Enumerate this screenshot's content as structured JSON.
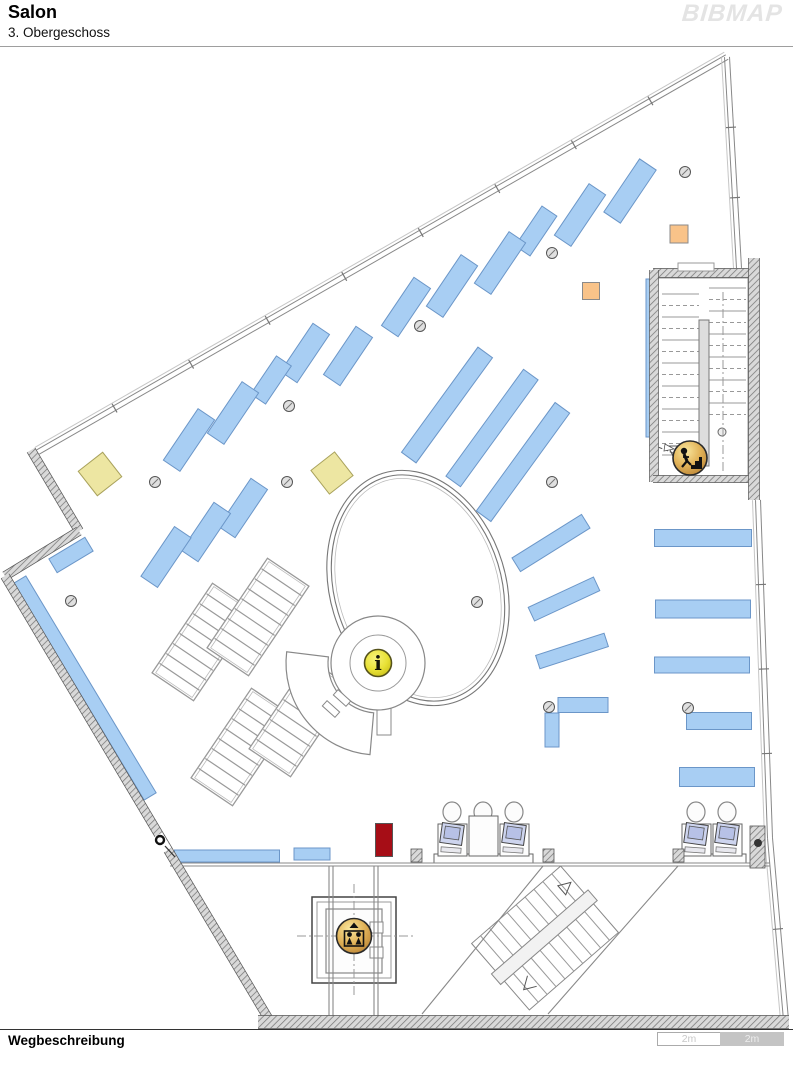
{
  "header": {
    "title": "Salon",
    "subtitle": "3. Obergeschoss",
    "logo": "BIBMAP"
  },
  "footer": {
    "label": "Wegbeschreibung",
    "scale": {
      "segments": [
        {
          "label": "2m"
        },
        {
          "label": "2m"
        }
      ]
    }
  },
  "colors": {
    "shelf_fill": "#A8CEF3",
    "shelf_stroke": "#6B96C8",
    "yellow_fill": "#EDE6A2",
    "yellow_stroke": "#A9A25C",
    "orange_fill": "#F9C389",
    "orange_stroke": "#8A8A8A",
    "red_fill": "#A60D16",
    "red_stroke": "#555555",
    "wall_line": "#555555",
    "icon_ring": "#2A2A2A",
    "info_yellow": "#E8E13C",
    "icon_gold": "#D9A93C"
  },
  "map": {
    "outline_walls": [
      [
        31,
        450,
        79,
        531,
        9
      ],
      [
        79,
        531,
        5,
        576,
        9
      ],
      [
        5,
        576,
        268,
        1018,
        9
      ],
      [
        258,
        1022,
        789,
        1022,
        13
      ],
      [
        653,
        273,
        757,
        273,
        9
      ],
      [
        654,
        270,
        654,
        482,
        9
      ],
      [
        653,
        479,
        757,
        479,
        7
      ],
      [
        754,
        258,
        754,
        500,
        11
      ]
    ],
    "glass_walls": [
      {
        "x1": 727,
        "y1": 57,
        "x2": 38,
        "y2": 452,
        "ticks": 9
      },
      {
        "x1": 727,
        "y1": 57,
        "x2": 739,
        "y2": 268,
        "ticks": 3
      },
      {
        "x1": 758,
        "y1": 500,
        "x2": 770,
        "y2": 838,
        "ticks": 4
      },
      {
        "x1": 770,
        "y1": 838,
        "x2": 786,
        "y2": 1020,
        "ticks": 2
      }
    ],
    "thin_walls": [
      [
        170,
        863,
        770,
        863
      ],
      [
        170,
        866,
        770,
        866
      ],
      [
        329,
        866,
        329,
        1016
      ],
      [
        333,
        866,
        333,
        1016
      ],
      [
        374,
        866,
        374,
        1016
      ],
      [
        378,
        866,
        378,
        1016
      ],
      [
        543,
        866,
        422,
        1014
      ],
      [
        678,
        866,
        548,
        1014
      ]
    ],
    "shelves": [
      [
        630,
        191,
        20,
        64,
        34
      ],
      [
        580,
        215,
        20,
        62,
        34
      ],
      [
        536,
        231,
        18,
        48,
        34
      ],
      [
        500,
        263,
        20,
        62,
        34
      ],
      [
        452,
        286,
        20,
        62,
        34
      ],
      [
        406,
        307,
        20,
        58,
        34
      ],
      [
        348,
        356,
        20,
        58,
        34
      ],
      [
        305,
        353,
        20,
        58,
        34
      ],
      [
        271,
        380,
        18,
        46,
        34
      ],
      [
        233,
        413,
        20,
        62,
        34
      ],
      [
        189,
        440,
        20,
        62,
        34
      ],
      [
        243,
        508,
        20,
        58,
        34
      ],
      [
        206,
        532,
        20,
        58,
        34
      ],
      [
        166,
        557,
        20,
        60,
        34
      ],
      [
        71,
        555,
        42,
        16,
        -31
      ],
      [
        85,
        688,
        14,
        253,
        -31
      ],
      [
        447,
        405,
        18,
        130,
        36
      ],
      [
        492,
        428,
        18,
        132,
        36
      ],
      [
        523,
        462,
        18,
        134,
        36
      ],
      [
        551,
        543,
        16,
        82,
        58
      ],
      [
        564,
        599,
        15,
        72,
        65
      ],
      [
        572,
        651,
        14,
        72,
        72
      ],
      [
        583,
        705,
        50,
        15,
        0
      ],
      [
        552,
        730,
        14,
        34,
        0
      ],
      [
        703,
        538,
        97,
        17,
        0
      ],
      [
        703,
        609,
        95,
        18,
        0
      ],
      [
        702,
        665,
        95,
        16,
        0
      ],
      [
        719,
        721,
        65,
        17,
        0
      ],
      [
        717,
        777,
        75,
        19,
        0
      ],
      [
        651,
        358,
        10,
        158,
        0
      ],
      [
        227,
        856,
        105,
        12,
        0
      ],
      [
        312,
        854,
        36,
        12,
        0
      ]
    ],
    "accents": [
      {
        "x": 100,
        "y": 474,
        "w": 31,
        "h": 31,
        "rot": -38,
        "c": "yellow"
      },
      {
        "x": 332,
        "y": 473,
        "w": 30,
        "h": 30,
        "rot": -38,
        "c": "yellow"
      },
      {
        "x": 679,
        "y": 234,
        "w": 18,
        "h": 18,
        "rot": 0,
        "c": "orange"
      },
      {
        "x": 591,
        "y": 291,
        "w": 17,
        "h": 17,
        "rot": 0,
        "c": "orange"
      },
      {
        "x": 384,
        "y": 840,
        "w": 17,
        "h": 33,
        "rot": 0,
        "c": "red"
      }
    ],
    "columns": [
      [
        155,
        482
      ],
      [
        287,
        482
      ],
      [
        289,
        406
      ],
      [
        420,
        326
      ],
      [
        552,
        253
      ],
      [
        685,
        172
      ],
      [
        552,
        482
      ],
      [
        477,
        602
      ],
      [
        71,
        601
      ],
      [
        549,
        707
      ],
      [
        688,
        708
      ]
    ],
    "tables": [
      [
        203,
        642,
        50,
        108,
        34
      ],
      [
        258,
        617,
        50,
        108,
        34
      ],
      [
        242,
        747,
        50,
        108,
        34
      ],
      [
        300,
        718,
        50,
        108,
        34
      ]
    ],
    "oval": {
      "cx": 418,
      "cy": 588,
      "rx": 88,
      "ry": 120,
      "rot": -17
    },
    "info_desk": {
      "cx": 378,
      "cy": 663
    },
    "stairwell": {
      "x": 658,
      "y": 278,
      "w": 90,
      "h": 200
    },
    "diag_stairs": {
      "cx": 545,
      "cy": 938,
      "rot": -41
    },
    "elevator": {
      "cx": 354,
      "cy": 940
    },
    "workstations": [
      {
        "x": 437,
        "y": 800,
        "bays": [
          1,
          2,
          1
        ]
      },
      {
        "x": 681,
        "y": 800,
        "bays": [
          1,
          1
        ]
      }
    ],
    "pillars": [
      [
        411,
        849,
        11,
        13
      ],
      [
        543,
        849,
        11,
        13
      ],
      [
        673,
        849,
        11,
        13
      ],
      [
        750,
        826,
        15,
        42
      ]
    ],
    "extras": [
      [
        678,
        263,
        36,
        8
      ]
    ],
    "door": {
      "cx": 160,
      "cy": 840
    },
    "dashdot": [
      [
        297,
        936,
        414,
        936
      ],
      [
        354,
        884,
        354,
        998
      ],
      [
        723,
        292,
        723,
        472
      ]
    ],
    "icons": [
      {
        "type": "info",
        "name": "info-icon",
        "label": "i",
        "x": 378,
        "y": 663
      },
      {
        "type": "stairs",
        "name": "stairs-down-icon",
        "x": 690,
        "y": 458
      },
      {
        "type": "elevator",
        "name": "elevator-icon",
        "x": 354,
        "y": 936
      }
    ]
  }
}
